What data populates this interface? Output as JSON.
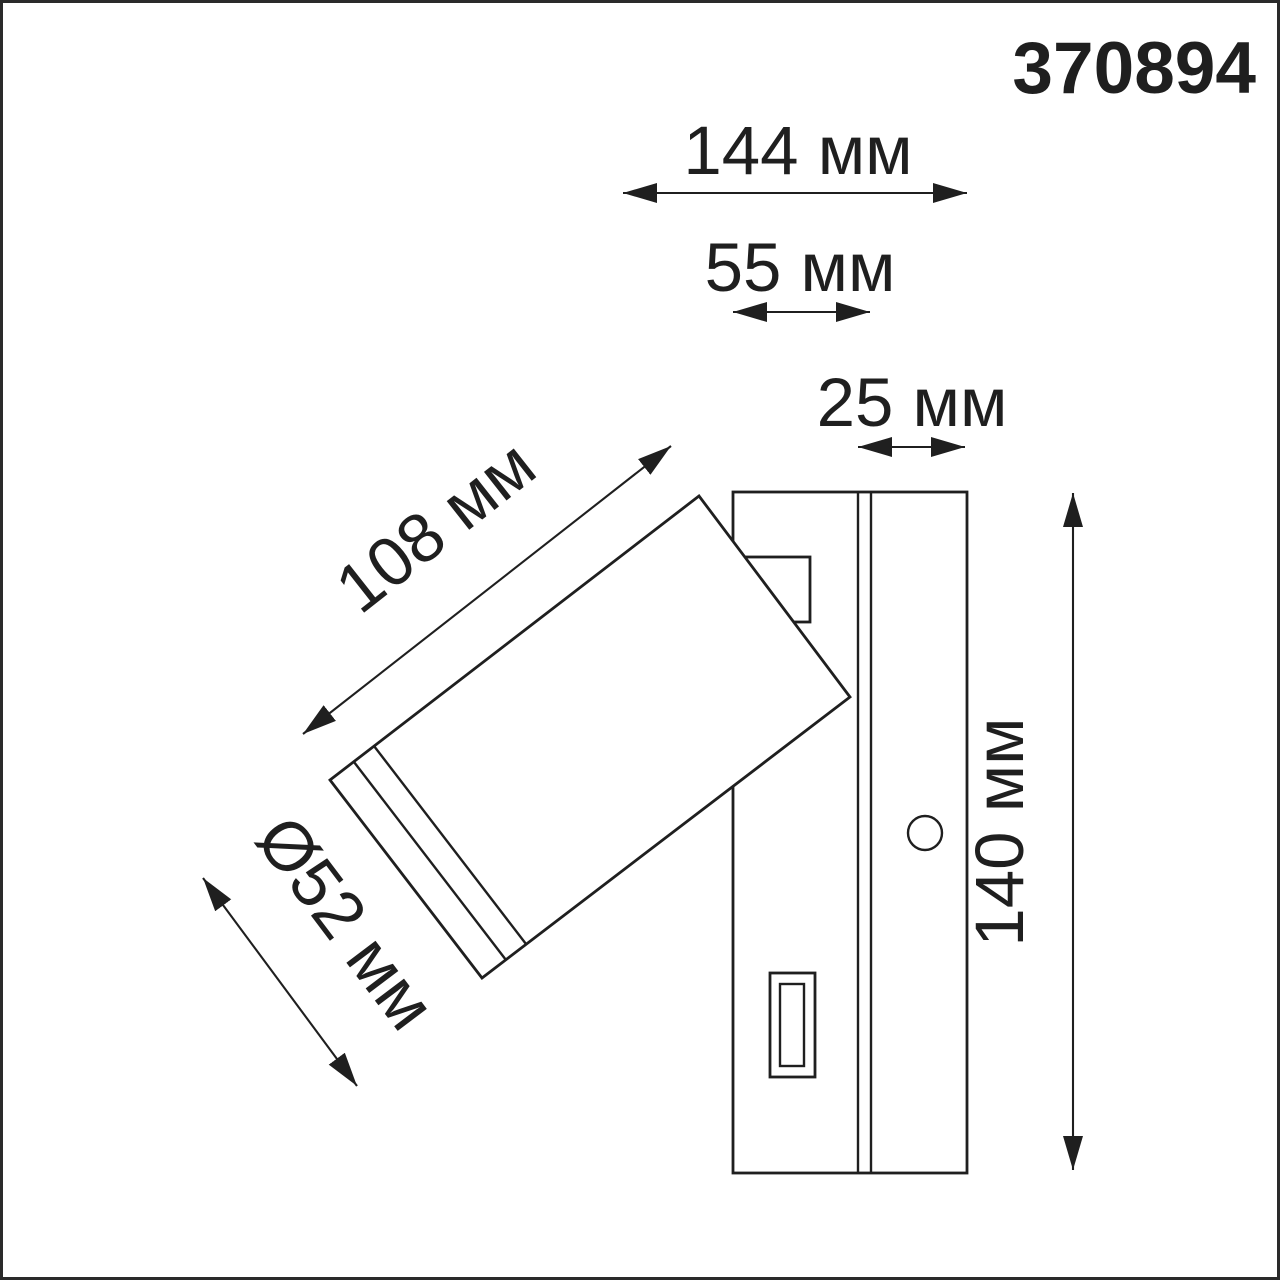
{
  "part_number": "370894",
  "dimensions": {
    "total_depth": "144 мм",
    "body_depth": "55 мм",
    "plate_depth": "25 мм",
    "head_length": "108 мм",
    "head_diameter": "Ø52 мм",
    "plate_height": "140 мм"
  },
  "colors": {
    "line": "#1f1f1f",
    "background": "#ffffff",
    "frame": "#2a2a2a"
  }
}
